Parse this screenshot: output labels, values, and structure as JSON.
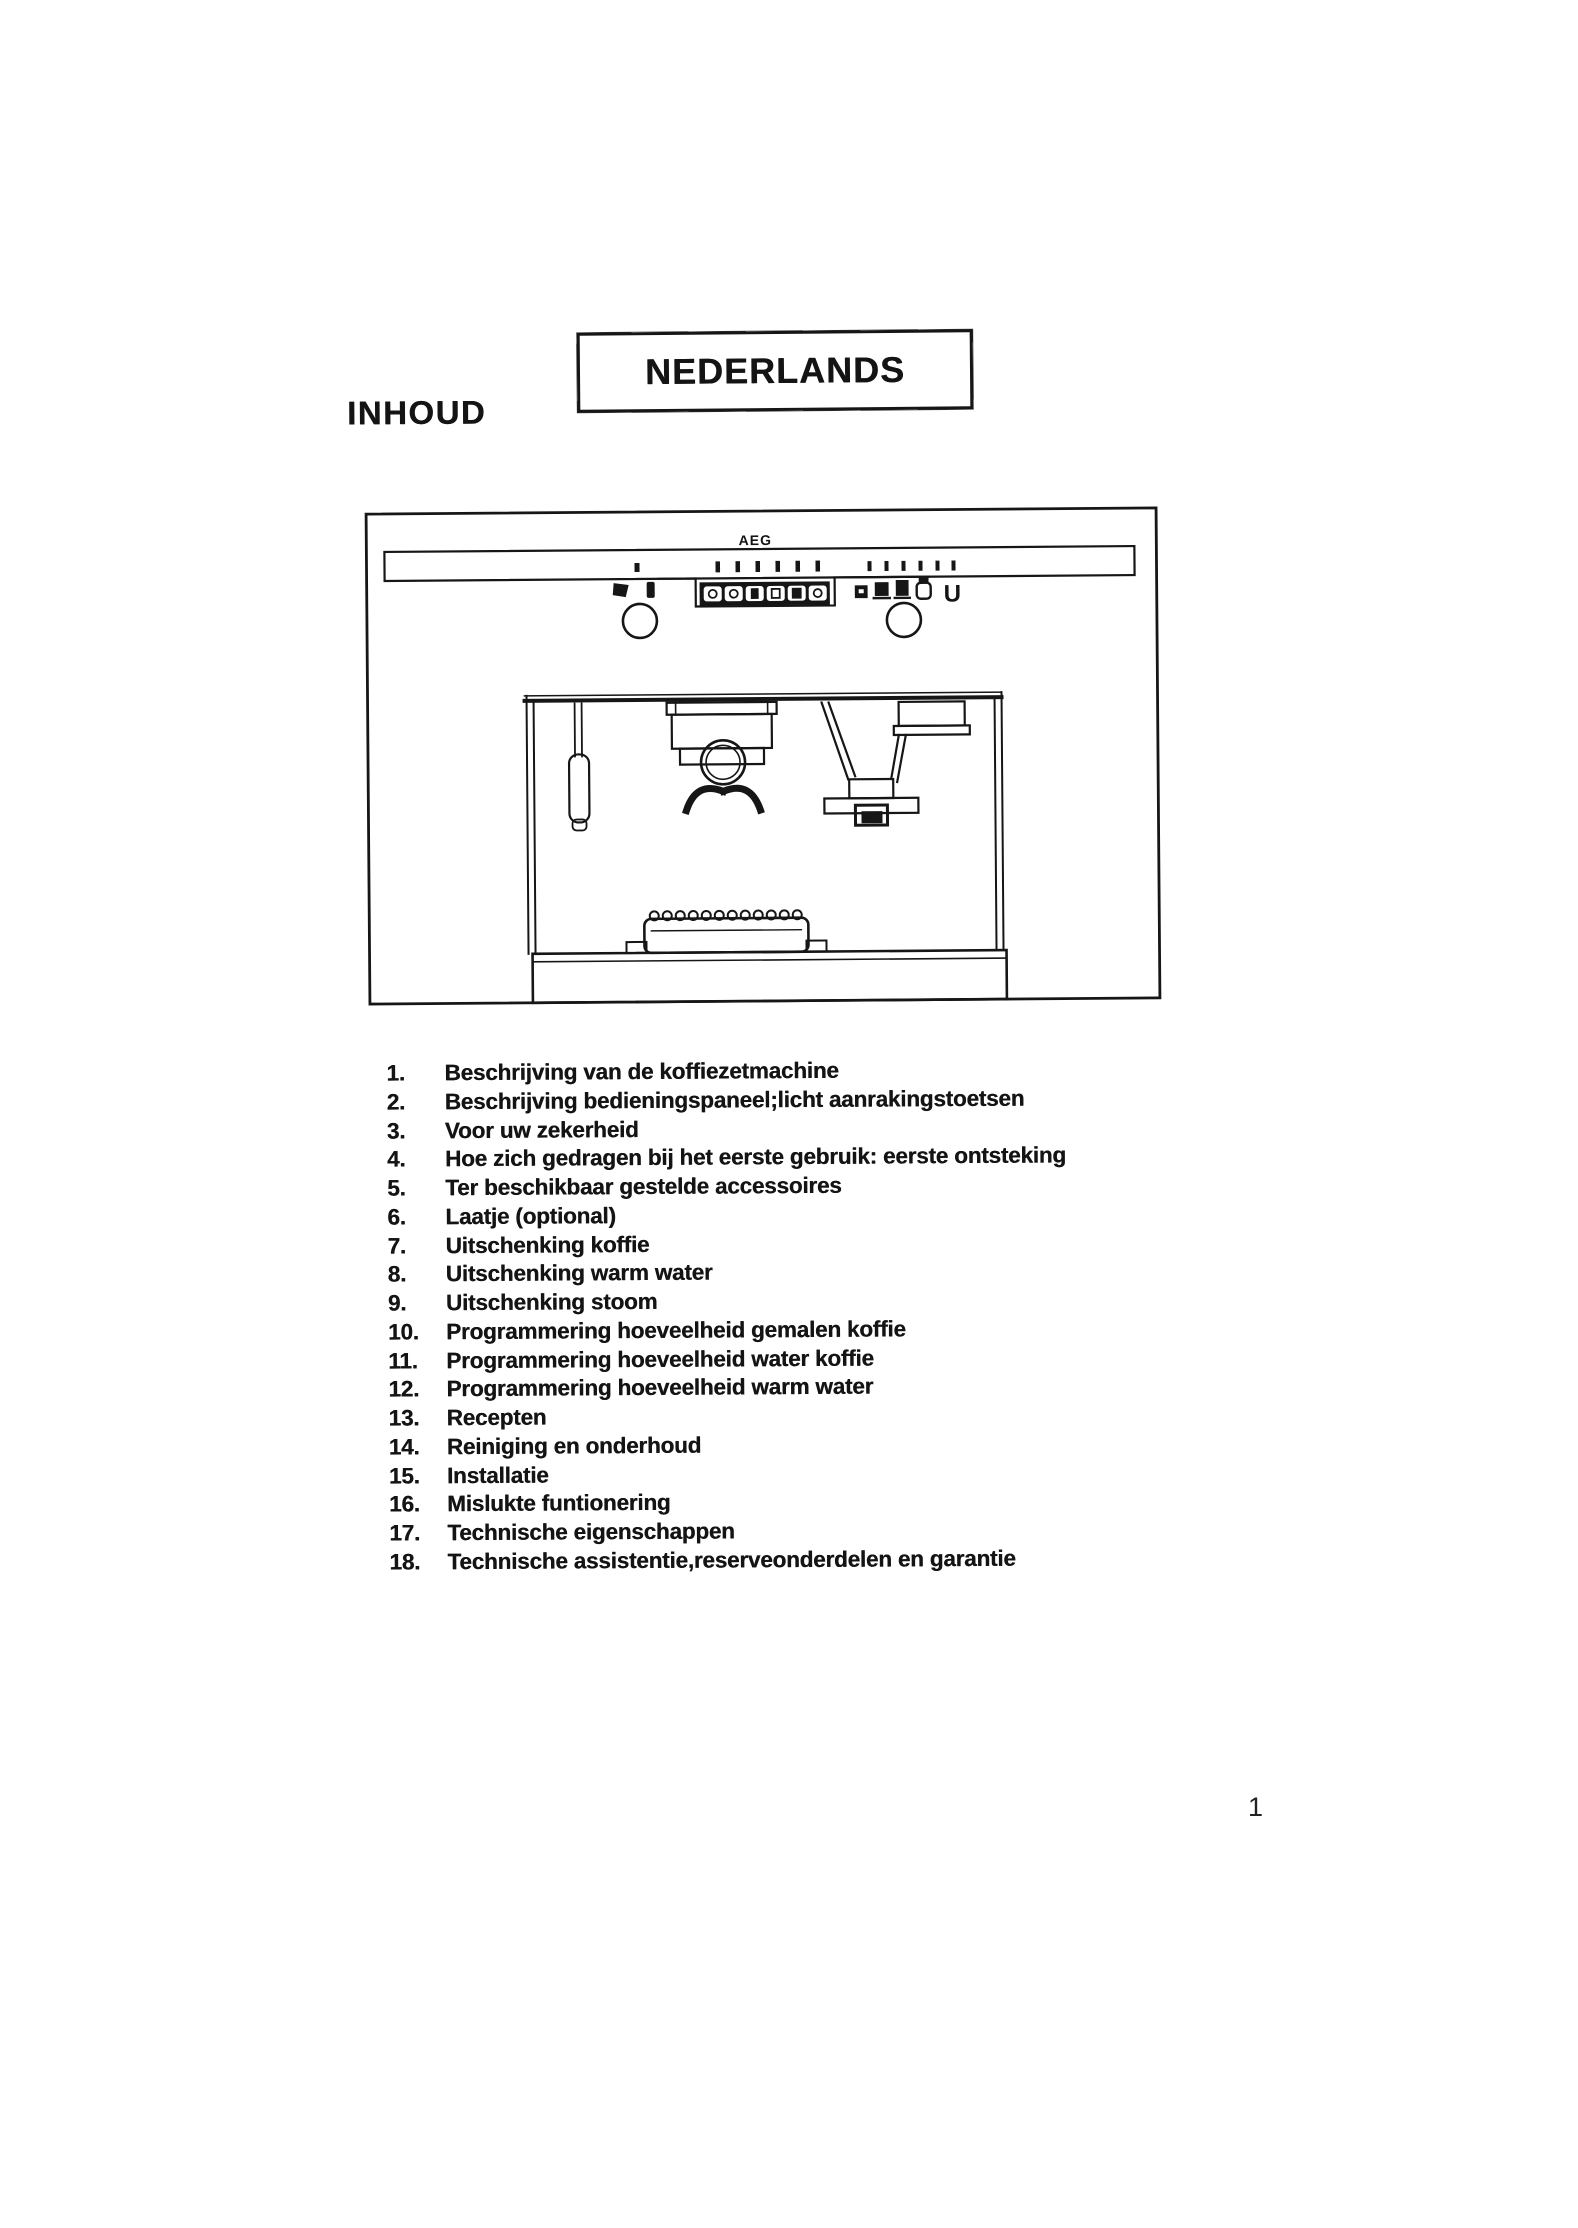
{
  "page": {
    "banner": "NEDERLANDS",
    "heading": "INHOUD",
    "page_number": "1"
  },
  "diagram": {
    "brand_label": "AEG",
    "power_symbol": "U"
  },
  "toc": {
    "items": [
      {
        "num": "1.",
        "label": "Beschrijving van de koffiezetmachine"
      },
      {
        "num": "2.",
        "label": "Beschrijving bedieningspaneel;licht aanrakingstoetsen"
      },
      {
        "num": "3.",
        "label": "Voor uw zekerheid"
      },
      {
        "num": "4.",
        "label": "Hoe zich gedragen bij het eerste gebruik: eerste ontsteking"
      },
      {
        "num": "5.",
        "label": "Ter beschikbaar gestelde accessoires"
      },
      {
        "num": "6.",
        "label": "Laatje (optional)"
      },
      {
        "num": "7.",
        "label": "Uitschenking koffie"
      },
      {
        "num": "8.",
        "label": "Uitschenking warm water"
      },
      {
        "num": "9.",
        "label": "Uitschenking stoom"
      },
      {
        "num": "10.",
        "label": "Programmering hoeveelheid gemalen koffie"
      },
      {
        "num": "11.",
        "label": "Programmering hoeveelheid water koffie"
      },
      {
        "num": "12.",
        "label": "Programmering hoeveelheid warm water"
      },
      {
        "num": "13.",
        "label": "Recepten"
      },
      {
        "num": "14.",
        "label": "Reiniging en onderhoud"
      },
      {
        "num": "15.",
        "label": "Installatie"
      },
      {
        "num": "16.",
        "label": "Mislukte funtionering"
      },
      {
        "num": "17.",
        "label": "Technische eigenschappen"
      },
      {
        "num": "18.",
        "label": "Technische assistentie,reserveonderdelen en garantie"
      }
    ]
  },
  "colors": {
    "ink": "#141414",
    "paper": "#ffffff"
  }
}
